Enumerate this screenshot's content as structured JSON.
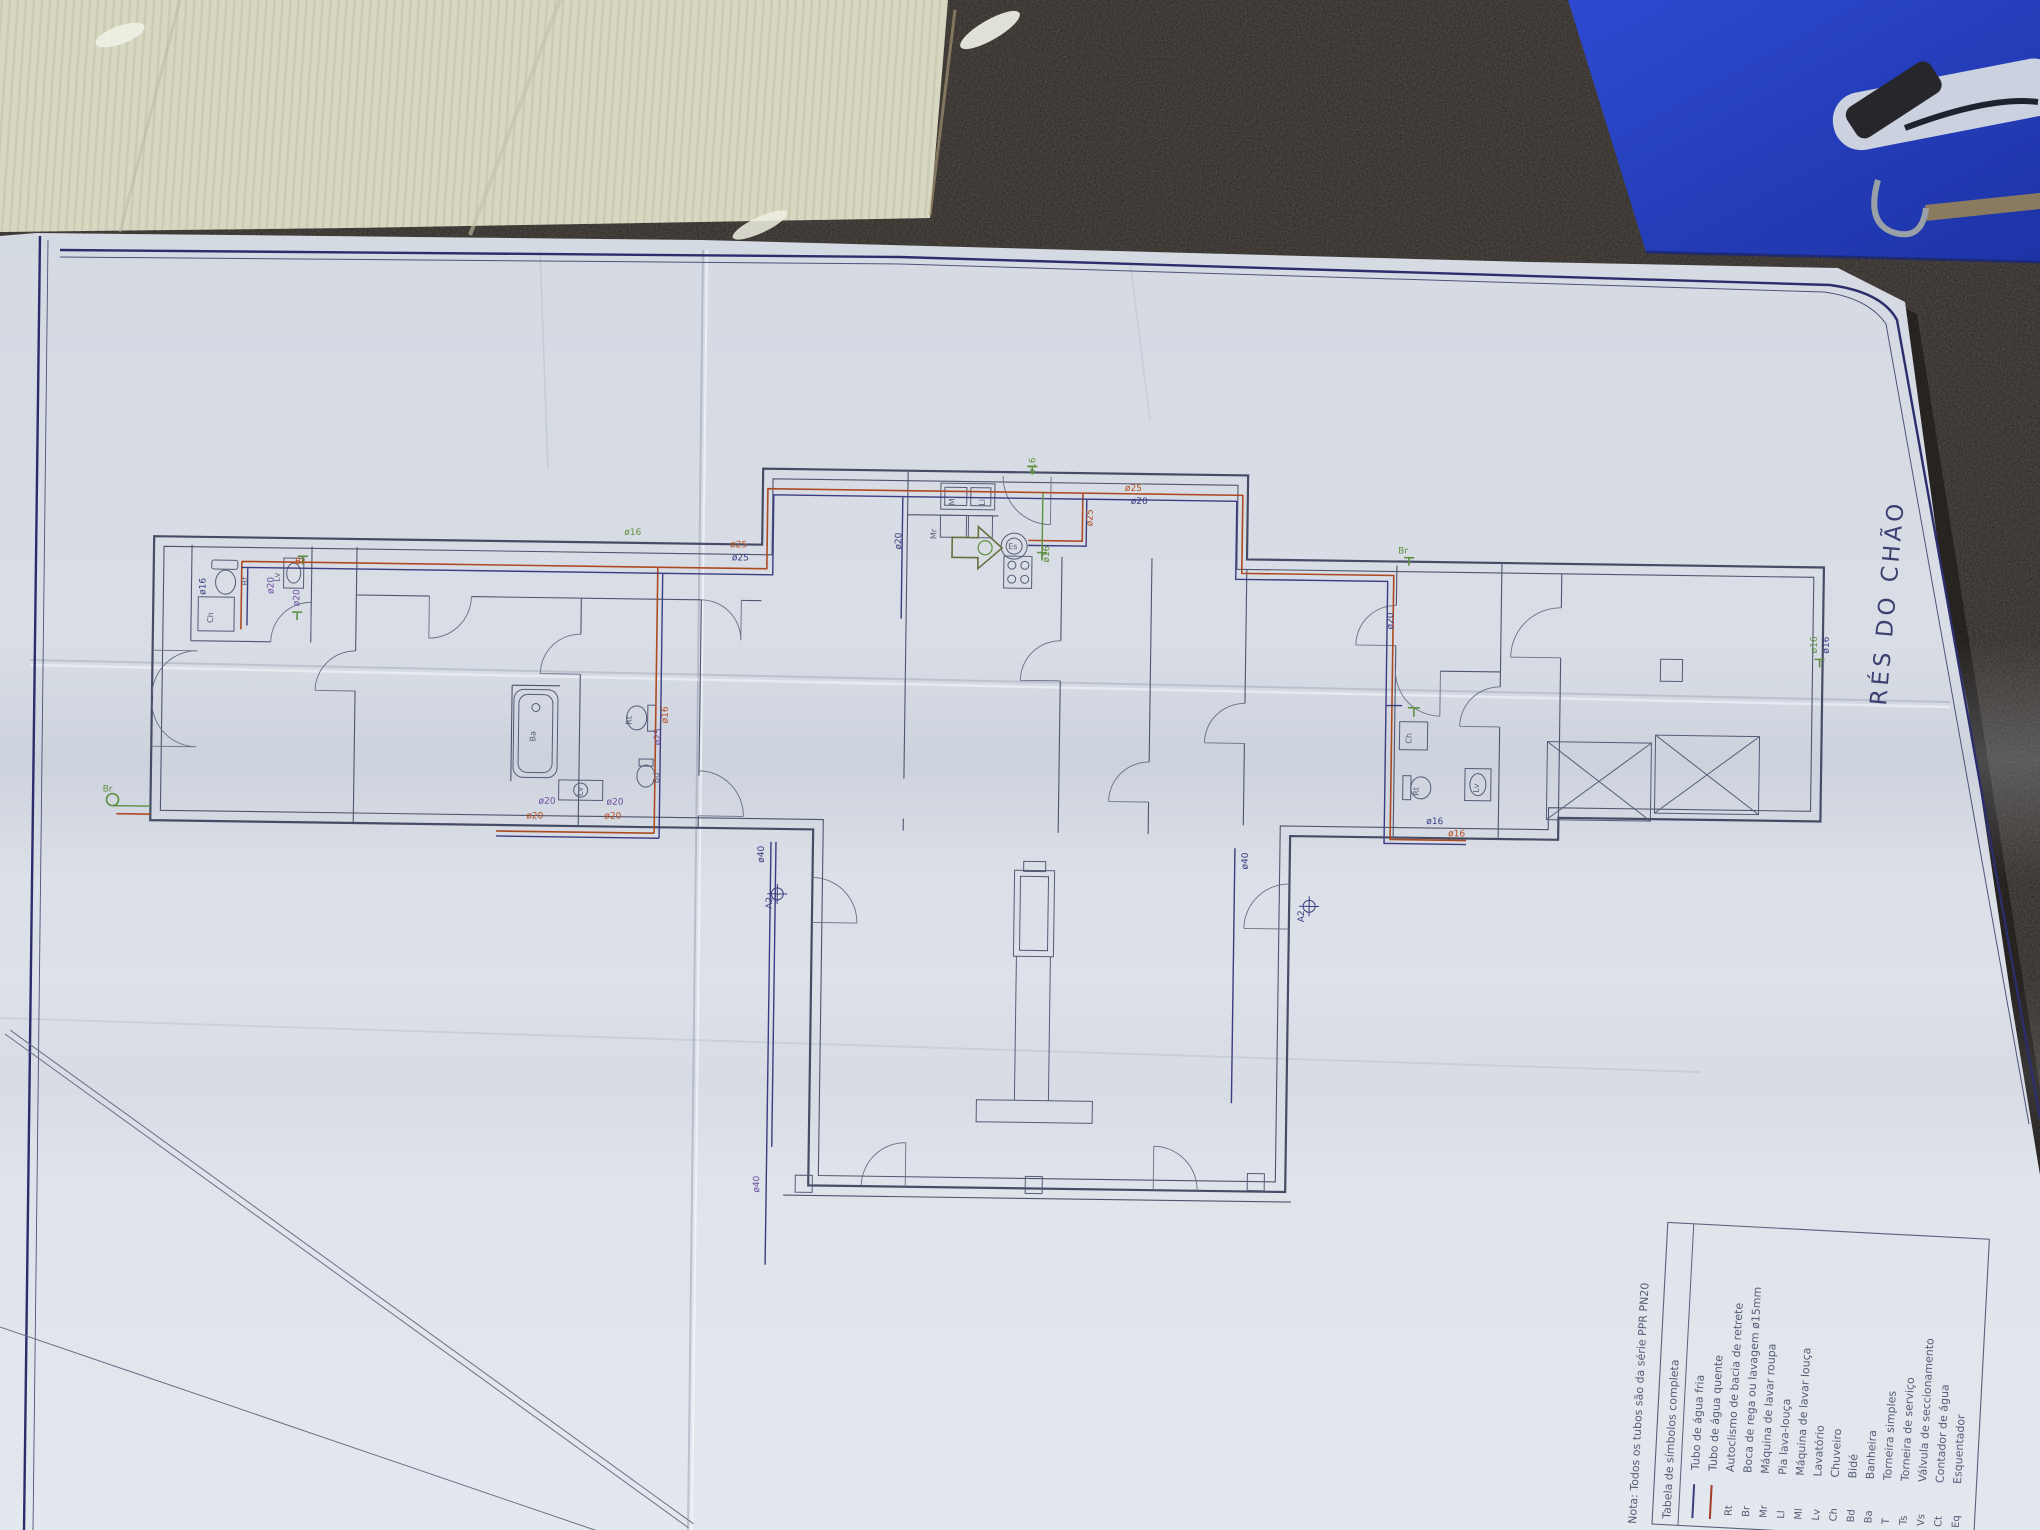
{
  "scene": {
    "surface": "dark-speckled-countertop",
    "objects": [
      "corrugated-cardboard-sheet",
      "blue-clipboard-with-clip",
      "folded-plan-sheet"
    ],
    "colors": {
      "countertop": "#2b2724",
      "cardboard": "#d6d6c0",
      "clipboard_blue": "#2742c4",
      "paper": "#e3e7ee",
      "sheet_border": "#2b2e6b",
      "wall_ink": "#474c66",
      "hot_pipe": "#ad4a22",
      "cold_pipe": "#3c3c80",
      "tap_green": "#5d8f3f",
      "label_purple": "#6b4fa0"
    }
  },
  "plan": {
    "title": "RÉS DO CHÃO",
    "note": "Nota: Todos os tubos são da série PPR PN20",
    "legend": {
      "title": "Tabela de símbolos completa",
      "rows": [
        {
          "sym": "",
          "line": "#3c3c80",
          "label": "Tubo de água fria"
        },
        {
          "sym": "",
          "line": "#a43b28",
          "label": "Tubo de água quente"
        },
        {
          "sym": "Rt",
          "label": "Autoclismo de bacia de retrete"
        },
        {
          "sym": "Br",
          "label": "Boca de rega ou lavagem ø15mm"
        },
        {
          "sym": "Mr",
          "label": "Máquina de lavar roupa"
        },
        {
          "sym": "Ll",
          "label": "Pia lava-louça"
        },
        {
          "sym": "Ml",
          "label": "Máquina de lavar louça"
        },
        {
          "sym": "Lv",
          "label": "Lavatório"
        },
        {
          "sym": "Ch",
          "label": "Chuveiro"
        },
        {
          "sym": "Bd",
          "label": "Bidé"
        },
        {
          "sym": "Ba",
          "label": "Banheira"
        },
        {
          "sym": "T",
          "label": "Torneira simples"
        },
        {
          "sym": "Ts",
          "label": "Torneira de serviço"
        },
        {
          "sym": "Vs",
          "label": "Válvula de seccionamento"
        },
        {
          "sym": "Ct",
          "label": "Contador de água"
        },
        {
          "sym": "Eq",
          "label": "Esquentador"
        }
      ]
    },
    "labels": {
      "d16": "ø16",
      "d20": "ø20",
      "d25": "ø25",
      "d40": "ø40",
      "a2": "A2"
    },
    "fixtures": {
      "rt": "Rt",
      "br": "Br",
      "mr": "Mr",
      "ll": "Ll",
      "ml": "Ml",
      "lv": "Lv",
      "ch": "Ch",
      "bd": "Bd",
      "ba": "Ba",
      "es": "Es"
    }
  },
  "labels": {
    "d16": "ø16",
    "d20": "ø20",
    "d25": "ø25",
    "d40": "ø40",
    "a2": "A2"
  },
  "fixtures": {
    "rt": "Rt",
    "br": "Br",
    "mr": "Mr",
    "ll": "Ll",
    "ml": "Ml",
    "lv": "Lv",
    "ch": "Ch",
    "bd": "Bd",
    "ba": "Ba",
    "es": "Es"
  }
}
